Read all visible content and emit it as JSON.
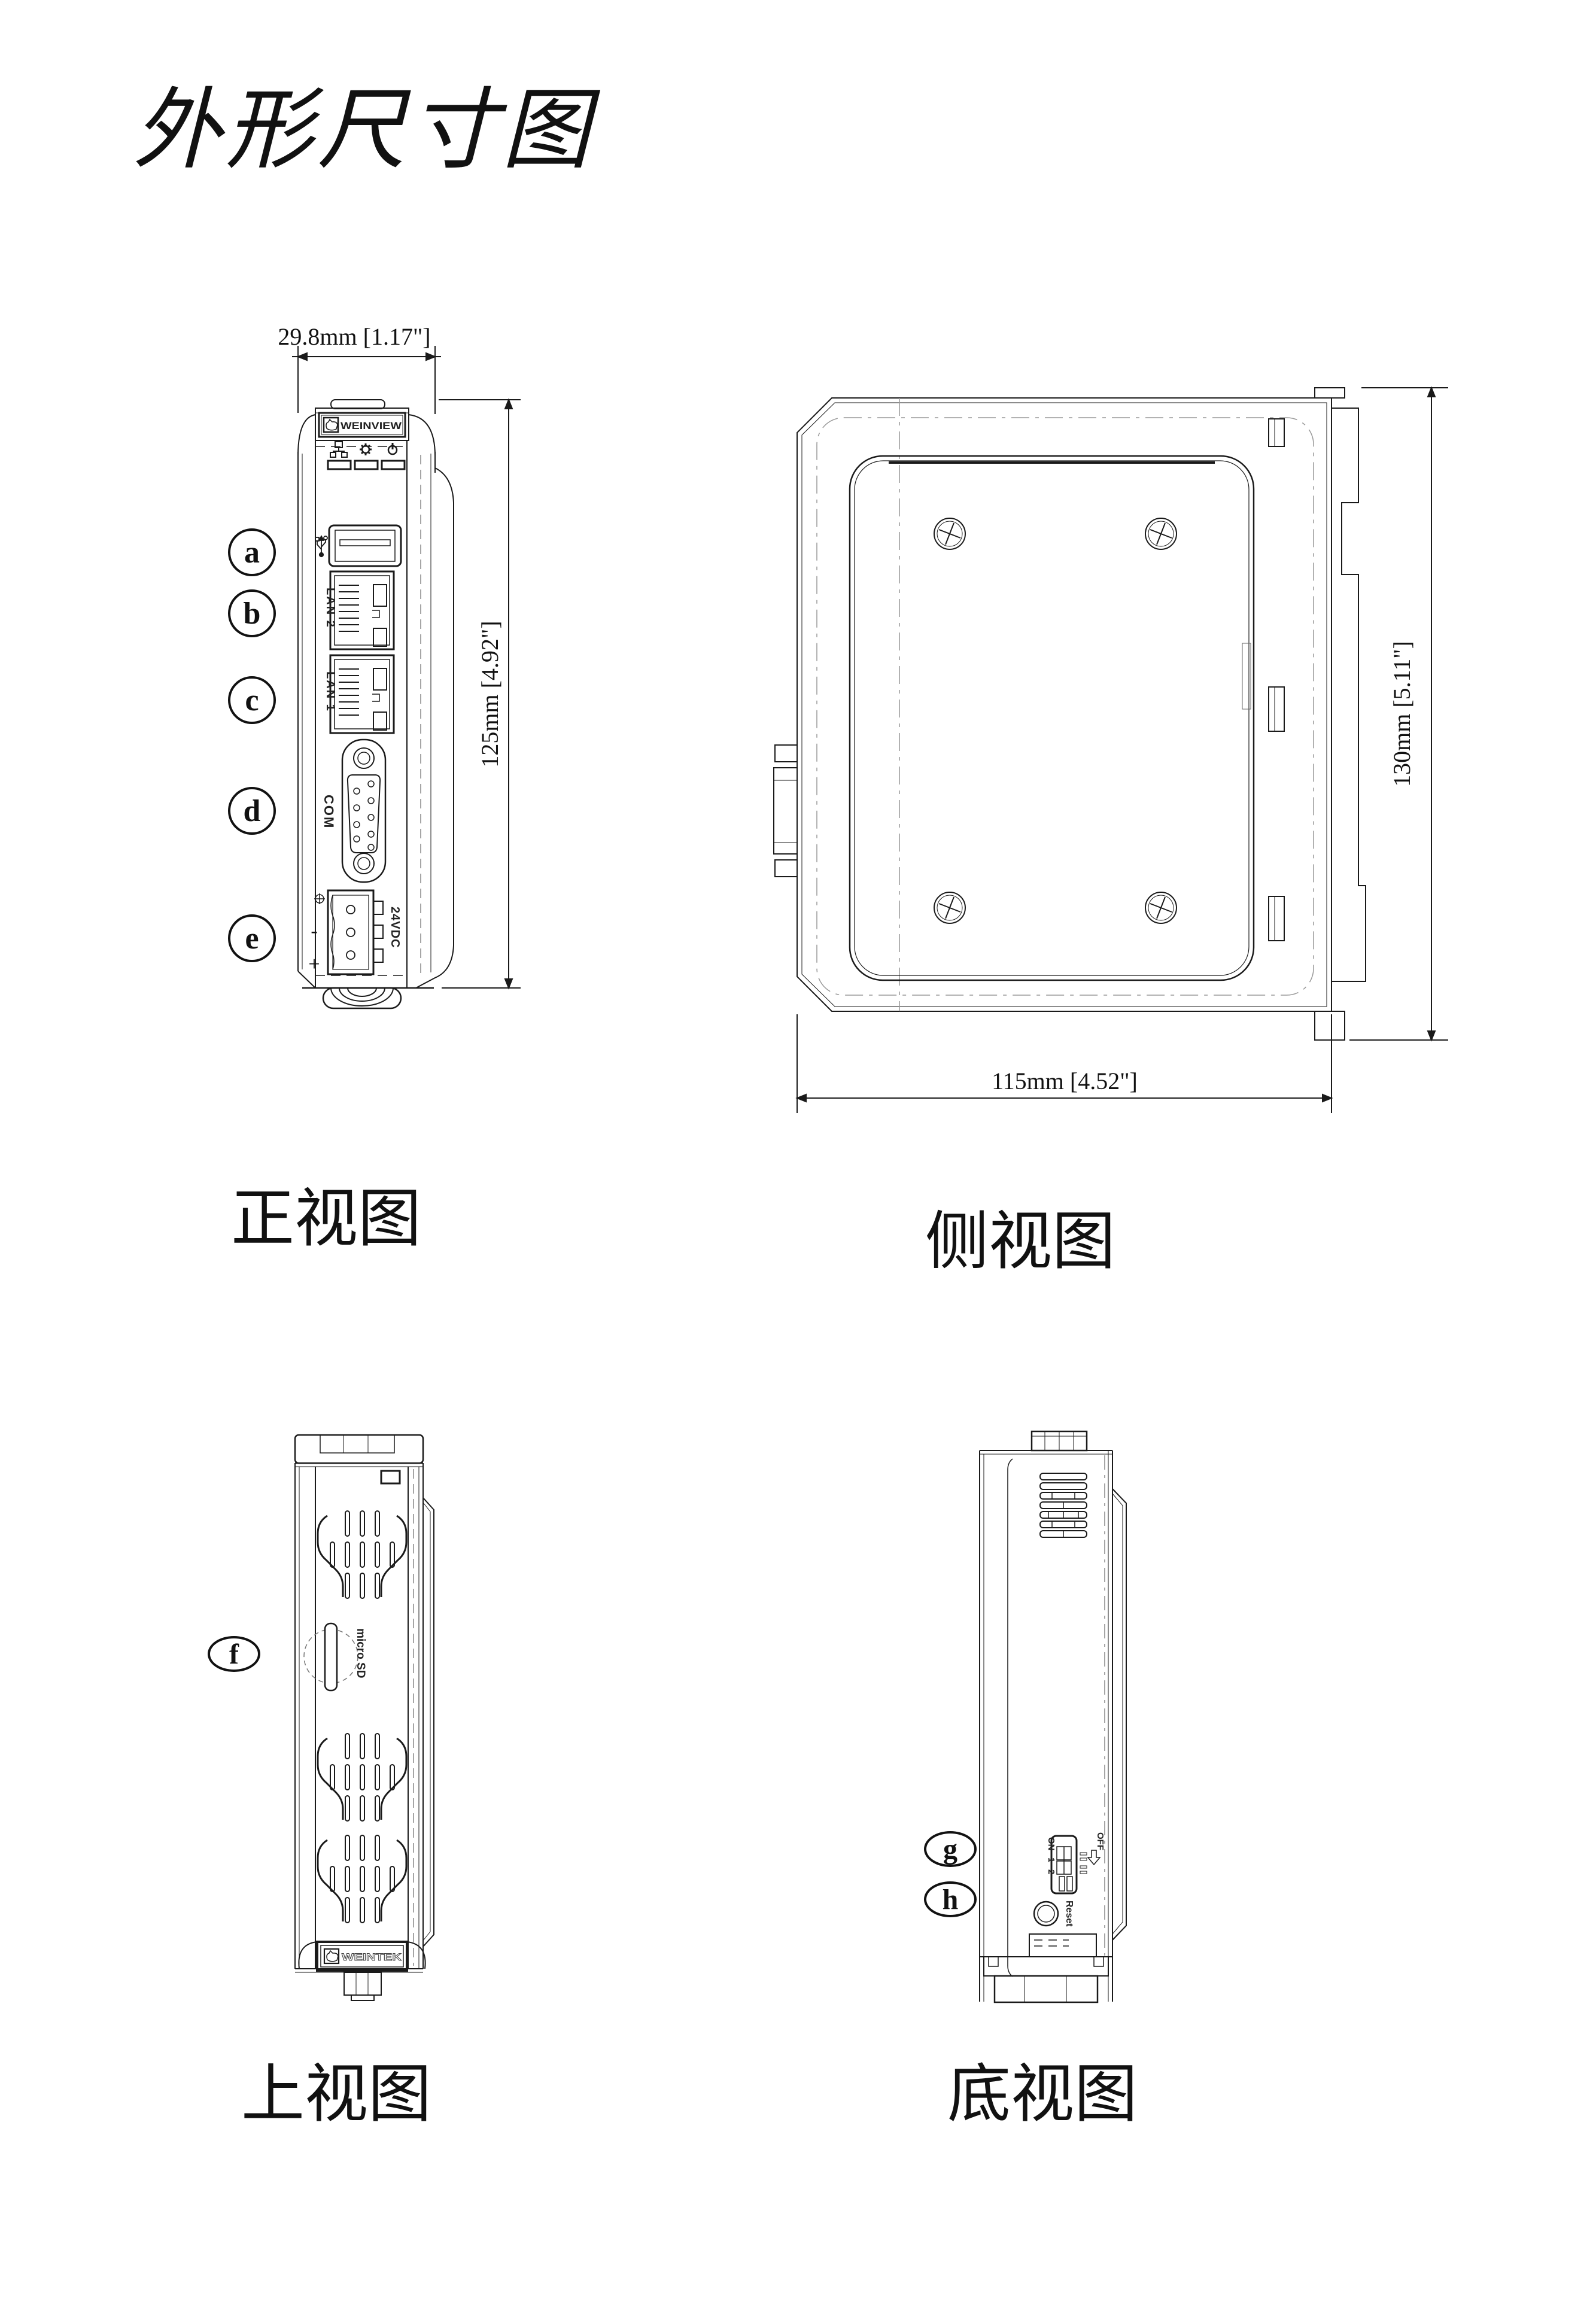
{
  "page": {
    "title": "外形尺寸图"
  },
  "views": {
    "front": {
      "caption": "正视图",
      "width_dim": "29.8mm [1.17\"]",
      "height_dim": "125mm [4.92\"]"
    },
    "side": {
      "caption": "侧视图",
      "height_dim": "130mm [5.11\"]",
      "width_dim": "115mm [4.52\"]"
    },
    "top": {
      "caption": "上视图"
    },
    "bottom": {
      "caption": "底视图"
    }
  },
  "callouts": {
    "a": "a",
    "b": "b",
    "c": "c",
    "d": "d",
    "e": "e",
    "f": "f",
    "g": "g",
    "h": "h"
  },
  "labels": {
    "brand_front": "WEINVIEW",
    "brand_top": "WEINTEK",
    "lan2": "LAN 2",
    "lan1": "LAN 1",
    "com": "COM",
    "power_terminal": "24VDC",
    "terminal_minus": "-",
    "terminal_plus": "+",
    "micro_sd": "micro SD",
    "dip_on": "ON",
    "dip_pos1": "1",
    "dip_pos2": "2",
    "dip_off": "OFF",
    "reset": "Reset"
  },
  "icons": {
    "usb": "usb-icon",
    "lan_led": "network-led-icon",
    "system_led": "gear-led-icon",
    "power_led": "power-led-icon",
    "touch_hand": "touch-hand-icon"
  },
  "colors": {
    "line": "#1a1a1a",
    "hidden_line": "#888888",
    "background": "#ffffff"
  }
}
